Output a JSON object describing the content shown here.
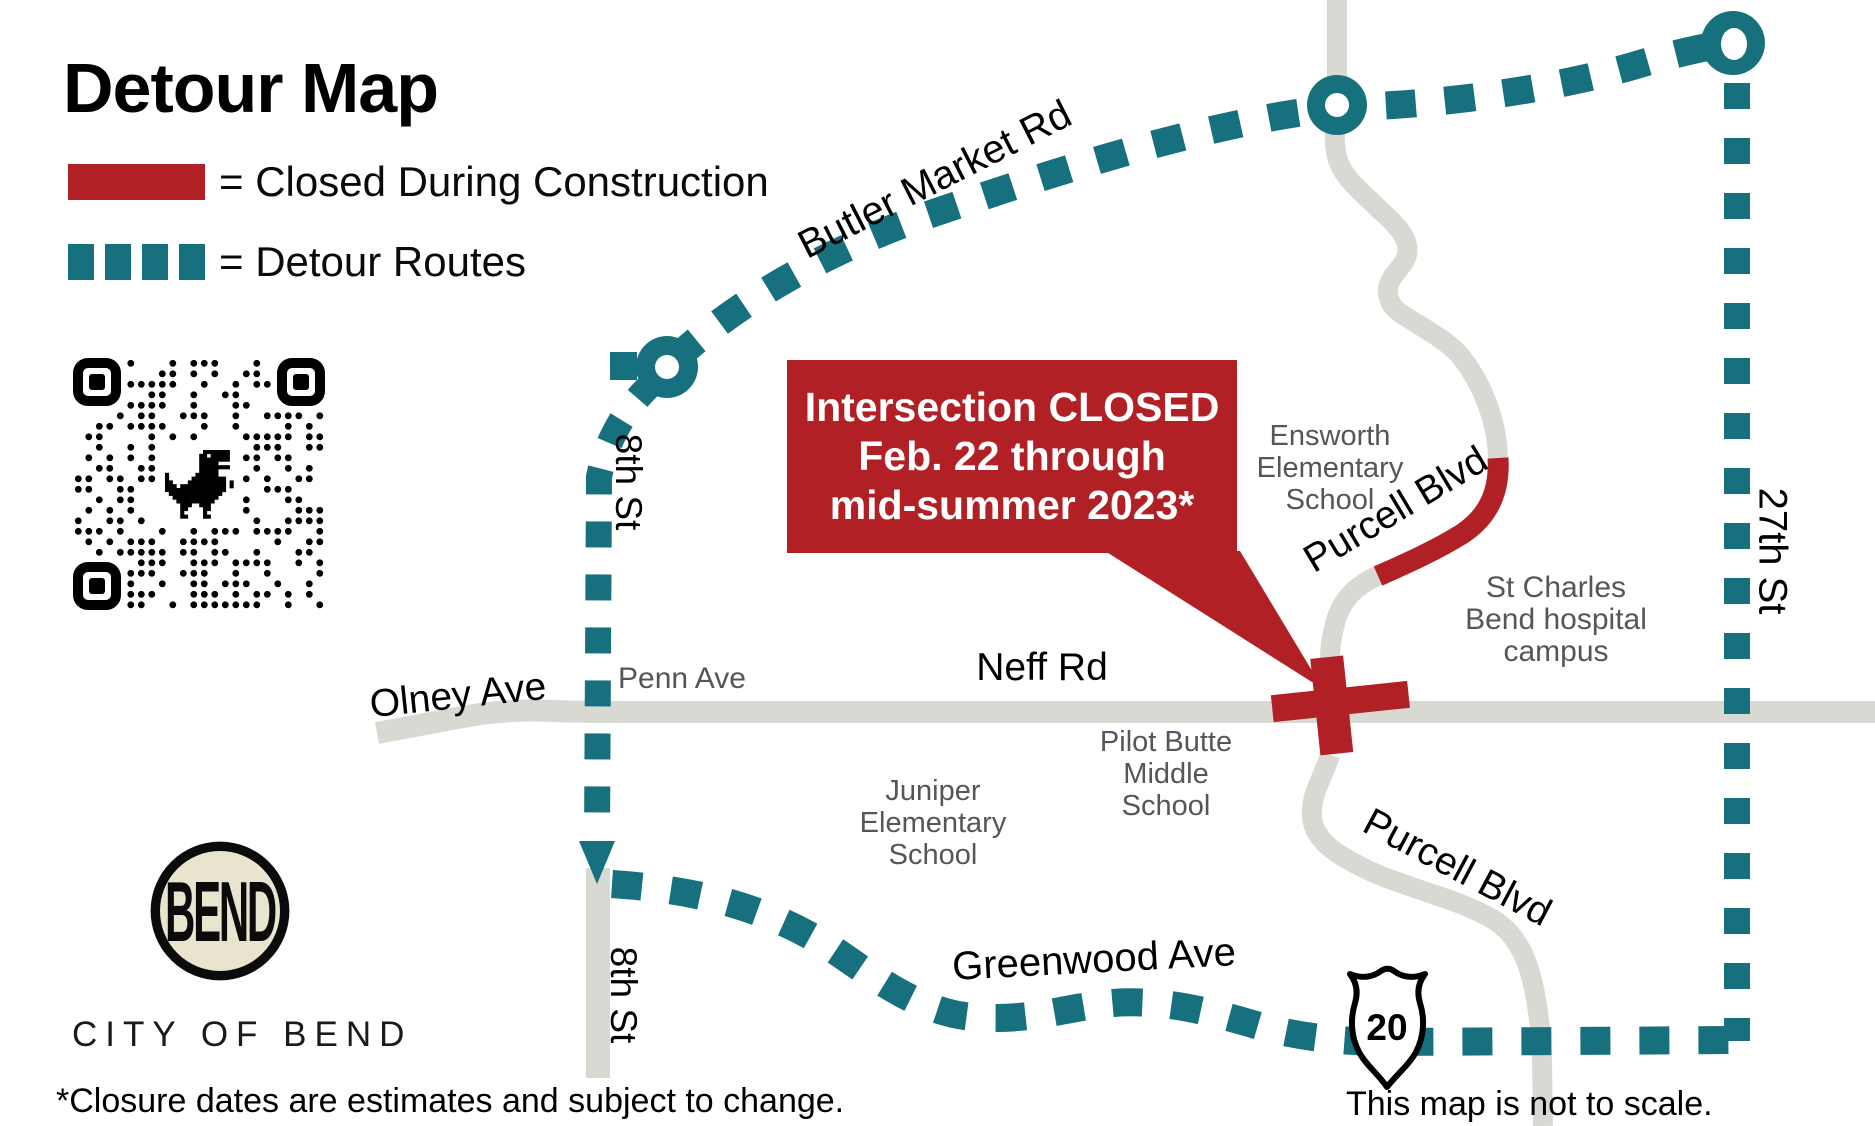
{
  "title": "Detour Map",
  "legend": {
    "closed_label": "= Closed During Construction",
    "detour_label": "= Detour Routes"
  },
  "colors": {
    "closed_red": "#b12025",
    "detour_teal": "#17707e",
    "road_gray": "#d9d9d4",
    "place_gray": "#55565a",
    "logo_cream": "#e8e4ce"
  },
  "callout": {
    "lines": [
      "Intersection CLOSED",
      "Feb. 22 through",
      "mid-summer 2023*"
    ]
  },
  "roads": {
    "butler_market": "Butler Market Rd",
    "eighth_st_upper": "8th St",
    "eighth_st_lower": "8th St",
    "twenty_seventh_st": "27th St",
    "olney": "Olney Ave",
    "penn": "Penn Ave",
    "neff": "Neff Rd",
    "purcell_north": "Purcell Blvd",
    "purcell_south": "Purcell Blvd",
    "greenwood": "Greenwood Ave"
  },
  "places": {
    "ensworth": [
      "Ensworth",
      "Elementary",
      "School"
    ],
    "st_charles": [
      "St Charles",
      "Bend hospital",
      "campus"
    ],
    "pilot_butte": [
      "Pilot Butte",
      "Middle",
      "School"
    ],
    "juniper": [
      "Juniper",
      "Elementary",
      "School"
    ]
  },
  "highway_shield": {
    "number": "20"
  },
  "logo": {
    "monogram": "BEND",
    "caption": "CITY OF BEND"
  },
  "footnotes": {
    "left": "*Closure dates are estimates and subject to change.",
    "right": "This map is not to scale."
  }
}
